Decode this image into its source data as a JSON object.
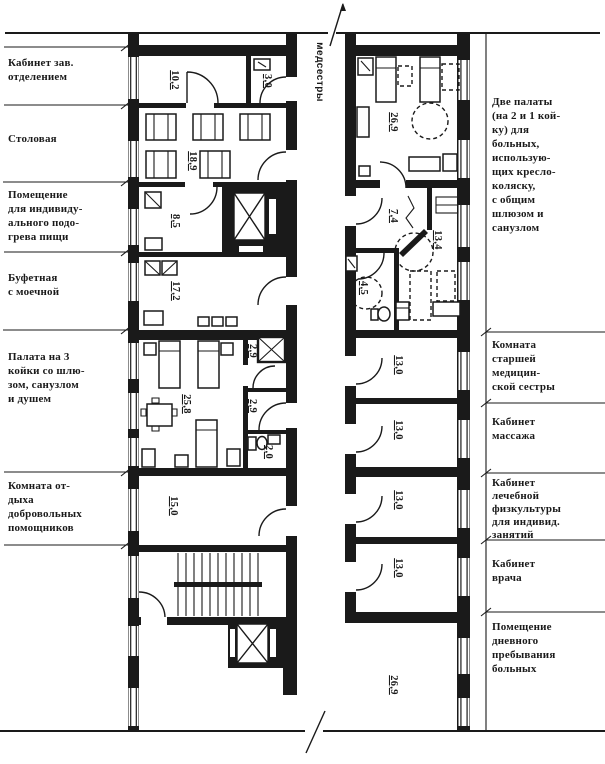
{
  "plan": {
    "ink": "#1a1a1a",
    "paper": "#ffffff",
    "corridor_label": "медсестры",
    "left_labels": [
      "Кабинет зав.\nотделением",
      "Столовая",
      "Помещение\nдля индивиду-\nального подо-\nгрева пищи",
      "Буфетная\nс моечной",
      "Палата на 3\nкойки со шлю-\nзом, санузлом\nи душем",
      "Комната от-\nдыха\nдобровольных\nпомощников"
    ],
    "right_labels": [
      "Две палаты\n(на 2 и 1 кой-\nку) для\nбольных,\nиспользую-\nщих кресло-\nколяску,\nс общим\nшлюзом и\nсанузлом",
      "Комната\nстаршей\nмедицин-\nской сестры",
      "Кабинет\nмассажа",
      "Кабинет\nлечебной\nфизкультуры\nдля индивид.\nзанятий",
      "Кабинет\nврача",
      "Помещение\nдневного\nпребывания\nбольных"
    ],
    "areas": {
      "head_office": "10,2",
      "washroom": "3,0",
      "dining": "18,9",
      "food_heating": "8,5",
      "pantry": "17,2",
      "ward3": "25,8",
      "shower": "2,9",
      "lock": "2,9",
      "wc": "2,0",
      "rest": "15,0",
      "ward2": "26,9",
      "vestibule": "7,4",
      "ward1": "13,4",
      "san_unit": "4,5",
      "nurse": "13,0",
      "massage": "13,0",
      "physio": "13,0",
      "doctor": "13,0",
      "day_room": "26,9"
    }
  }
}
